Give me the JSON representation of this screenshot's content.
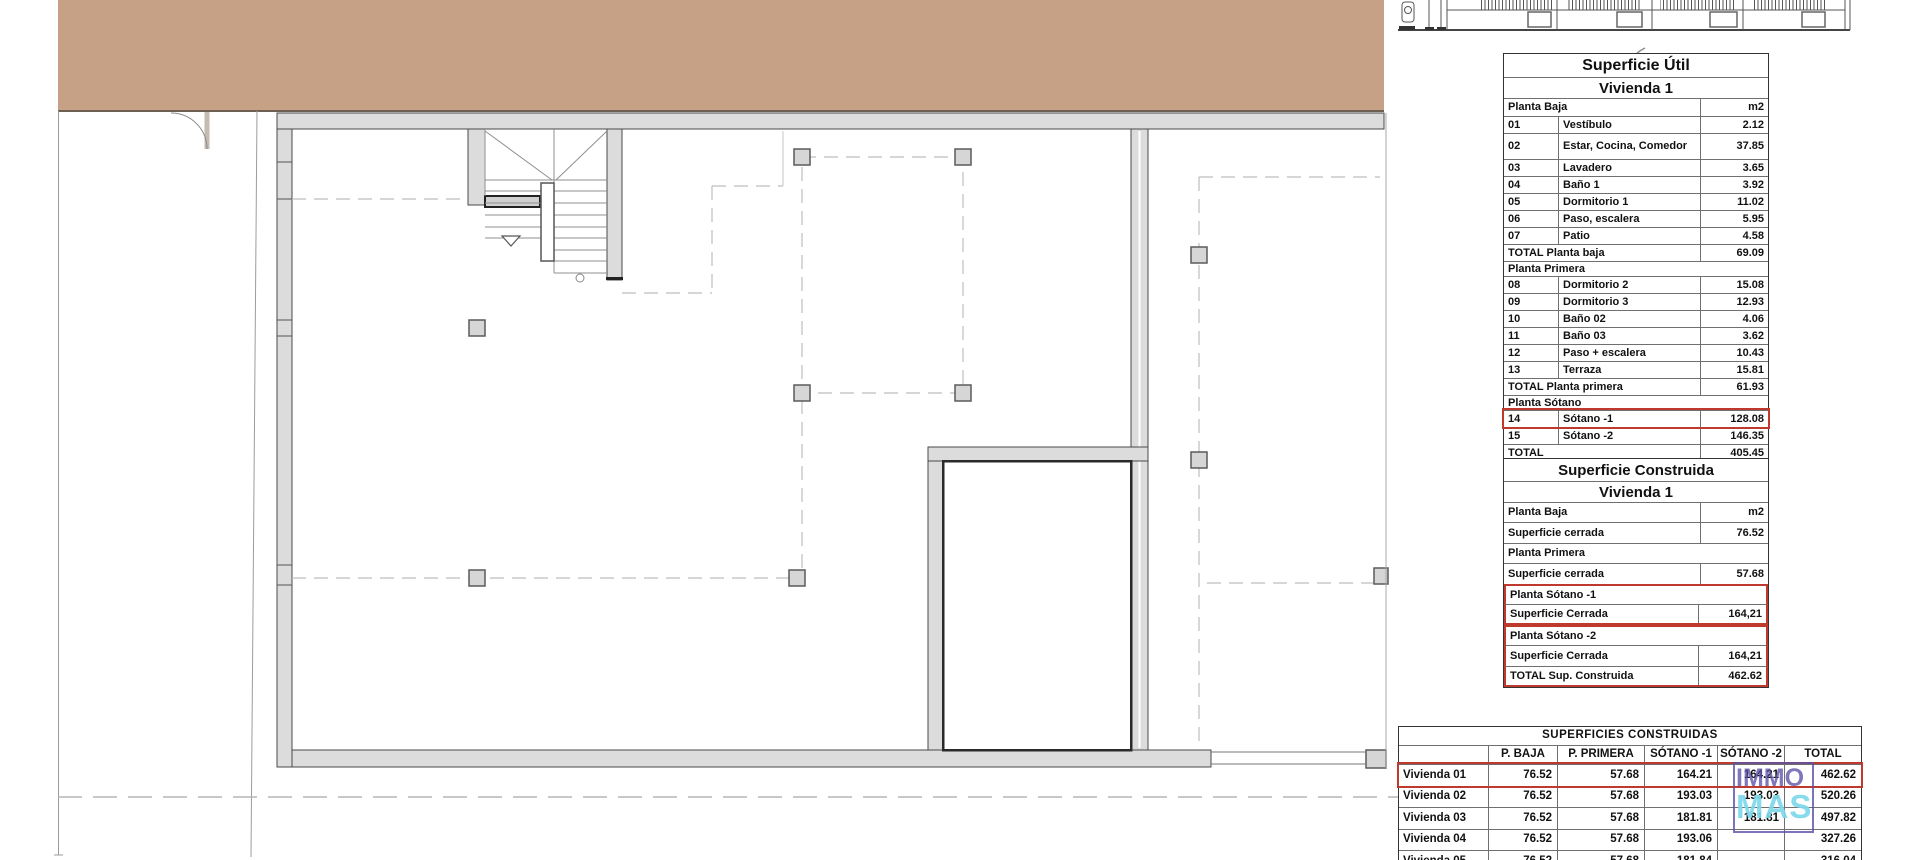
{
  "util": {
    "title": "Superficie Útil",
    "subtitle": "Vivienda 1",
    "rows": [
      {
        "t": "head",
        "c1": "Planta Baja",
        "c3": "m2"
      },
      {
        "t": "item",
        "c1": "01",
        "c2": "Vestíbulo",
        "c3": "2.12"
      },
      {
        "t": "item2",
        "c1": "02",
        "c2": "Estar, Cocina, Comedor",
        "c3": "37.85"
      },
      {
        "t": "item",
        "c1": "03",
        "c2": "Lavadero",
        "c3": "3.65"
      },
      {
        "t": "item",
        "c1": "04",
        "c2": "Baño 1",
        "c3": "3.92"
      },
      {
        "t": "item",
        "c1": "05",
        "c2": "Dormitorio 1",
        "c3": "11.02"
      },
      {
        "t": "item",
        "c1": "06",
        "c2": "Paso, escalera",
        "c3": "5.95"
      },
      {
        "t": "item",
        "c1": "07",
        "c2": "Patio",
        "c3": "4.58"
      },
      {
        "t": "total",
        "c1": "TOTAL Planta baja",
        "c3": "69.09"
      },
      {
        "t": "section",
        "c1": "Planta Primera"
      },
      {
        "t": "item",
        "c1": "08",
        "c2": "Dormitorio 2",
        "c3": "15.08"
      },
      {
        "t": "item",
        "c1": "09",
        "c2": "Dormitorio 3",
        "c3": "12.93"
      },
      {
        "t": "item",
        "c1": "10",
        "c2": "Baño 02",
        "c3": "4.06"
      },
      {
        "t": "item",
        "c1": "11",
        "c2": "Baño 03",
        "c3": "3.62"
      },
      {
        "t": "item",
        "c1": "12",
        "c2": "Paso + escalera",
        "c3": "10.43"
      },
      {
        "t": "item",
        "c1": "13",
        "c2": "Terraza",
        "c3": "15.81"
      },
      {
        "t": "total",
        "c1": "TOTAL Planta primera",
        "c3": "61.93"
      },
      {
        "t": "section",
        "c1": "Planta Sótano"
      },
      {
        "t": "item",
        "c1": "14",
        "c2": "Sótano -1",
        "c3": "128.08",
        "hl": true
      },
      {
        "t": "item",
        "c1": "15",
        "c2": "Sótano -2",
        "c3": "146.35"
      },
      {
        "t": "total",
        "c1": "TOTAL",
        "c3": "405.45"
      }
    ]
  },
  "constr": {
    "title": "Superficie Construida",
    "subtitle": "Vivienda 1",
    "rows": [
      {
        "t": "head",
        "c1": "Planta Baja",
        "c3": "m2"
      },
      {
        "t": "item",
        "c1": "Superficie cerrada",
        "c3": "76.52"
      },
      {
        "t": "section",
        "c1": "Planta Primera"
      },
      {
        "t": "item",
        "c1": "Superficie cerrada",
        "c3": "57.68"
      },
      {
        "t": "section",
        "c1": "Planta Sótano -1",
        "g": "a-start"
      },
      {
        "t": "item",
        "c1": "Superficie Cerrada",
        "c3": "164,21",
        "g": "a-end"
      },
      {
        "t": "section",
        "c1": "Planta Sótano -2",
        "g": "b-start"
      },
      {
        "t": "item",
        "c1": "Superficie Cerrada",
        "c3": "164,21",
        "g": "b-mid"
      },
      {
        "t": "total",
        "c1": "TOTAL Sup. Construida",
        "c3": "462.62",
        "g": "b-end"
      }
    ]
  },
  "summary": {
    "title": "SUPERFICIES CONSTRUIDAS",
    "headers": [
      "",
      "P. BAJA",
      "P. PRIMERA",
      "SÓTANO -1",
      "SÓTANO -2",
      "TOTAL"
    ],
    "rows": [
      {
        "name": "Vivienda 01",
        "v": [
          "76.52",
          "57.68",
          "164.21",
          "164.21",
          "462.62"
        ],
        "hl": true
      },
      {
        "name": "Vivienda 02",
        "v": [
          "76.52",
          "57.68",
          "193.03",
          "193.03",
          "520.26"
        ]
      },
      {
        "name": "Vivienda 03",
        "v": [
          "76.52",
          "57.68",
          "181.81",
          "181.81",
          "497.82"
        ]
      },
      {
        "name": "Vivienda 04",
        "v": [
          "76.52",
          "57.68",
          "193.06",
          "",
          "327.26"
        ]
      },
      {
        "name": "Vivienda 05",
        "v": [
          "76.52",
          "57.68",
          "181.84",
          "",
          "316.04"
        ]
      }
    ]
  },
  "watermark": {
    "line1": "IMMO",
    "line2": "MAS"
  },
  "colors": {
    "highlight_red": "#bf3a2c",
    "watermark_purple": "#5b51a8",
    "watermark_cyan": "#7dd8ec",
    "terrace_tan": "#c7a186",
    "wall_gray": "#dcdcdc"
  }
}
